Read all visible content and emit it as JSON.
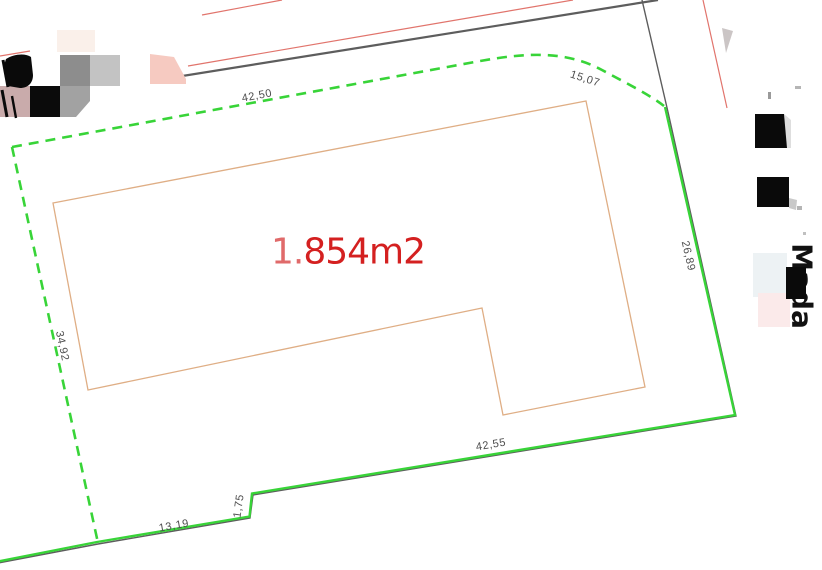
{
  "plan": {
    "area_label": {
      "prefix": "1.",
      "main": "854m2",
      "full_text": "1.854m2"
    },
    "dimensions": {
      "top": "42,50",
      "corner": "15,07",
      "right": "26,89",
      "left": "34,92",
      "bottom": "42,55",
      "step": "1,75",
      "bottom_left": "13,19"
    },
    "handwritten_note": "Mada"
  },
  "colors": {
    "boundary_green": "#38d438",
    "road_center_gray": "#5d5d5d",
    "road_edge_red": "#e1746c",
    "building_outline_tan": "#dfae85",
    "dimension_text_gray": "#4e4e4e",
    "area_text_red": "#d42020",
    "area_prefix_red": "#e06a6a",
    "note_black": "#111111"
  }
}
